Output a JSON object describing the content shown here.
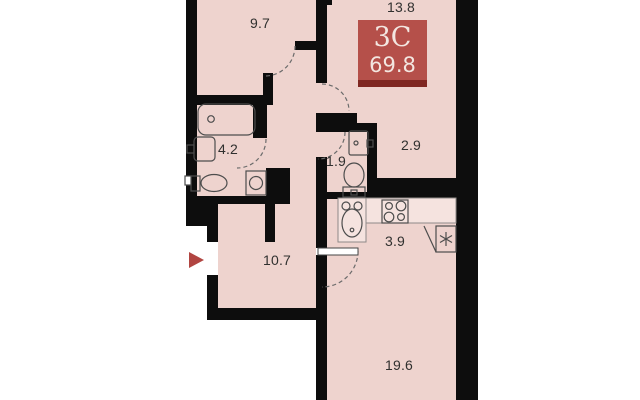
{
  "floor_plan": {
    "badge": {
      "unit_type": "3C",
      "total_area": "69.8"
    },
    "rooms": {
      "bedroom1": {
        "area": "9.7"
      },
      "bedroom2": {
        "area": "13.8"
      },
      "bathroom": {
        "area": "4.2"
      },
      "wc": {
        "area": "1.9"
      },
      "storage": {
        "area": "2.9"
      },
      "hallway": {
        "area": "10.7"
      },
      "kitchen": {
        "area": "3.9"
      },
      "living": {
        "area": "19.6"
      }
    },
    "fixtures": [
      "bathtub",
      "washbasin",
      "toilet",
      "washing-machine",
      "wc-sink",
      "wc-toilet",
      "kitchen-sink",
      "stove",
      "refrigerator"
    ],
    "colors": {
      "floor": "#eed3ce",
      "wall": "#0d0d0d",
      "badge_bg": "#b5504a",
      "badge_strip": "#7f2722",
      "badge_text": "#f3e6e0",
      "entry_arrow": "#b14541",
      "counter": "#f5e3df"
    }
  }
}
